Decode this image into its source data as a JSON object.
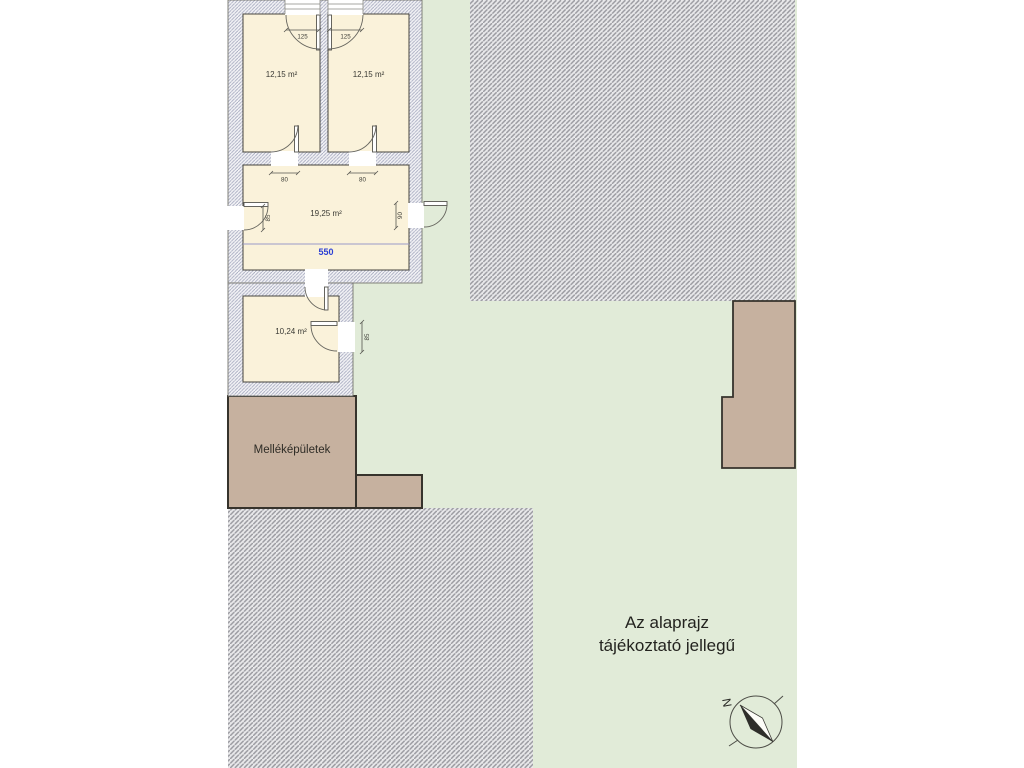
{
  "plan": {
    "rooms": [
      {
        "id": "room-top-left",
        "area": "12,15 m²"
      },
      {
        "id": "room-top-right",
        "area": "12,15 m²"
      },
      {
        "id": "room-middle",
        "area": "19,25 m²"
      },
      {
        "id": "room-small",
        "area": "10,24 m²"
      }
    ],
    "dimensions": {
      "window_left": "125",
      "window_right": "125",
      "door_top_left": "80",
      "door_top_right": "80",
      "door_middle_left": "85",
      "door_middle_right": "90",
      "door_small_right": "85",
      "room_width": "550"
    },
    "outbuilding_label": "Melléképületek",
    "note_line1": "Az alaprajz",
    "note_line2": "tájékoztató jellegű",
    "compass_north": "N",
    "colors": {
      "plot_green": "#e1ebd8",
      "room_cream": "#faf2da",
      "outbuilding_brown": "#c6b19f",
      "wall_hatch_line": "#a7abc0",
      "neighbor_hatch_line": "#9b9ba1",
      "dimension_blue": "#2b3fd4"
    }
  }
}
